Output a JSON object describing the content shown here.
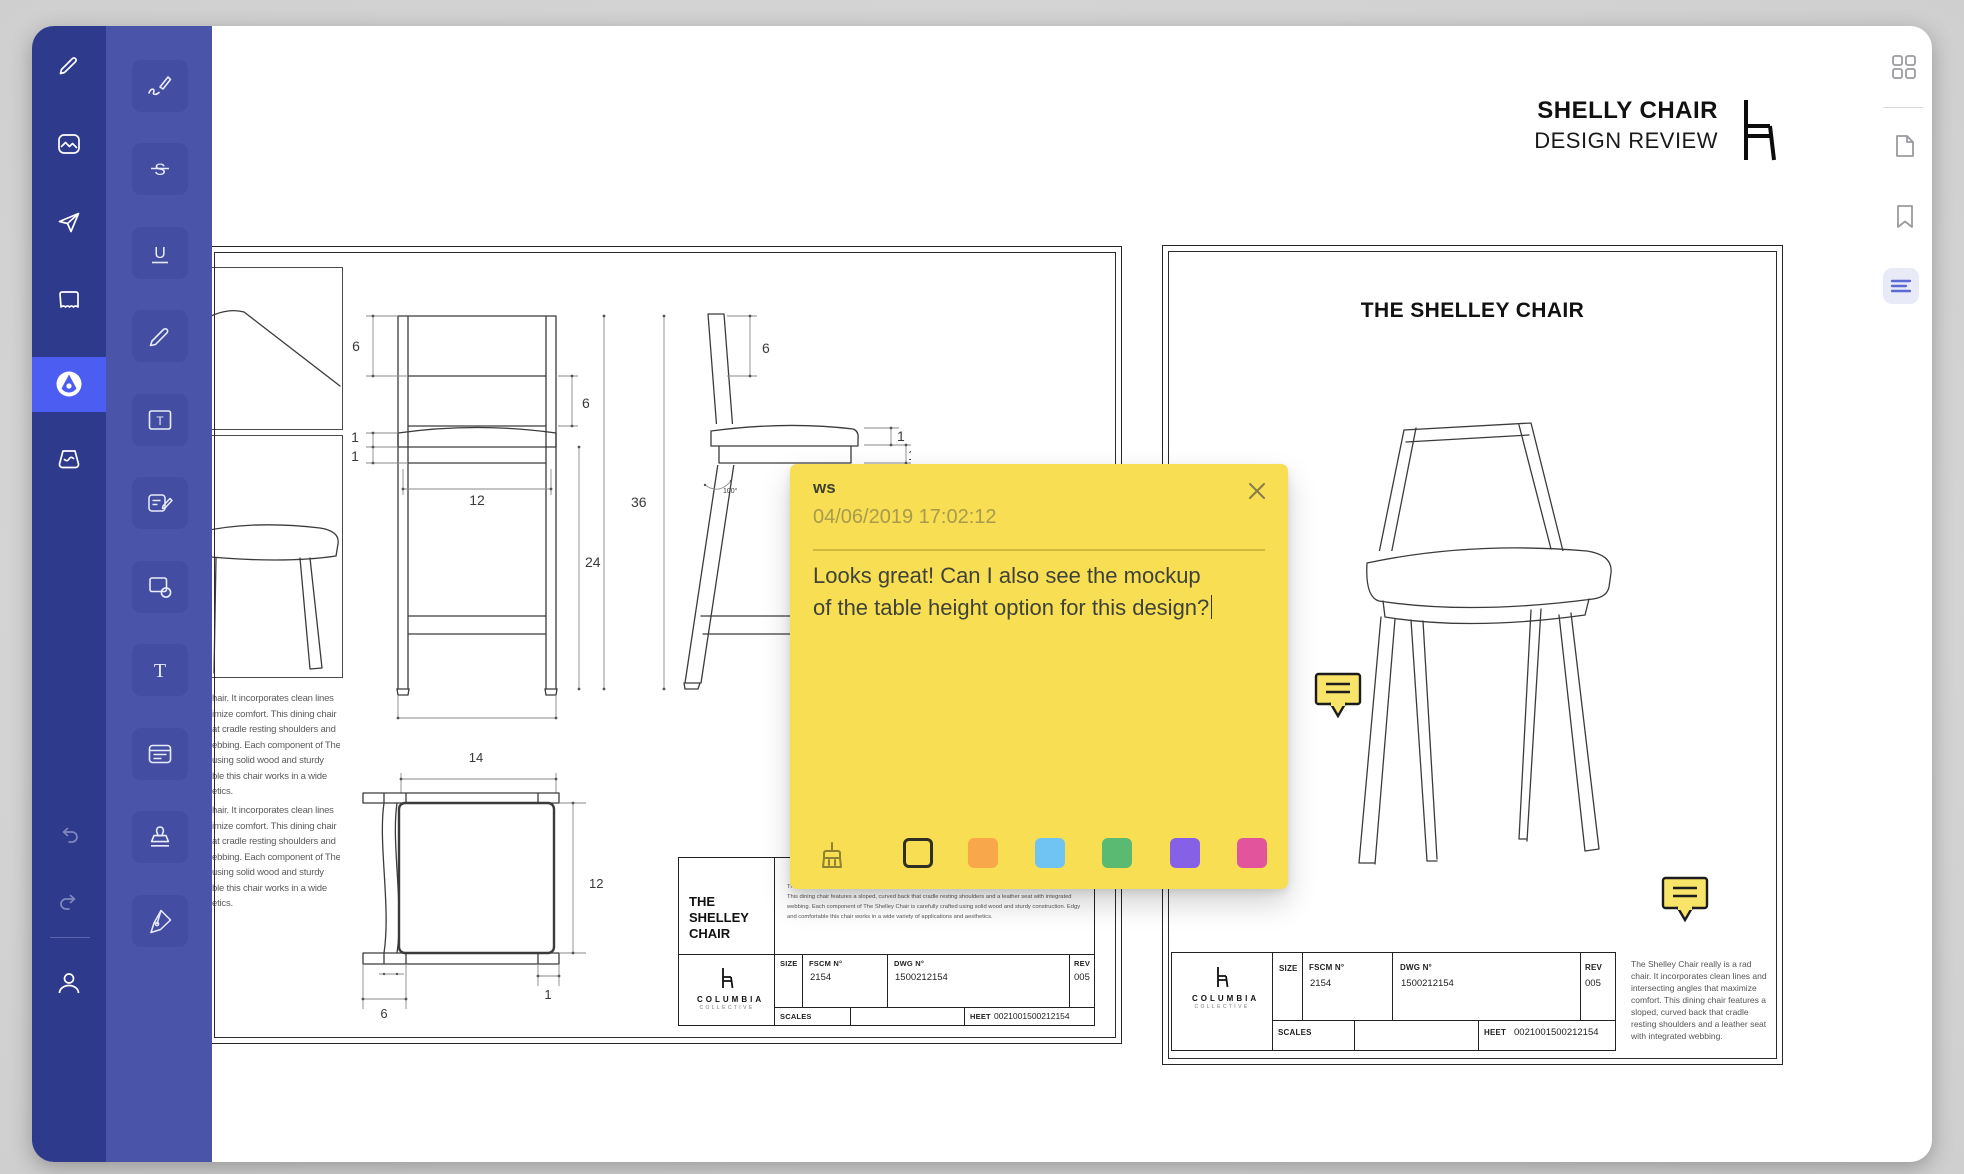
{
  "header": {
    "title": "SHELLY CHAIR",
    "subtitle": "DESIGN REVIEW"
  },
  "colors": {
    "note_bg": "#F8DE52",
    "marker_bg": "#F8E468",
    "sidebar_primary_bg": "#2E3A8C",
    "sidebar_tools_bg": "#4A55A9",
    "tool_button_bg": "#434EA3",
    "active_item_bg": "#4C5EF1",
    "rail_active_bg": "#E8EBF7",
    "rail_active_icon": "#5B6BD5",
    "swatches": [
      "#F9A74B",
      "#70C4F4",
      "#5BBA72",
      "#8661E8",
      "#E2549B"
    ]
  },
  "glyphs": {
    "strikethrough": "S",
    "underline": "U",
    "text_box": "T",
    "text": "T"
  },
  "note": {
    "author": "ws",
    "timestamp": "04/06/2019 17:02:12",
    "body_line1": "Looks great! Can I also see the mockup",
    "body_line2": "of the table height option for this design?"
  },
  "sheets": {
    "left": {
      "clipped_paragraph": [
        "hair. It incorporates clean lines",
        "imize comfort. This dining chair",
        "at cradle resting shoulders and",
        "ebbing. Each component of The",
        "using solid wood and sturdy",
        "ble this chair works in a wide",
        "etics."
      ],
      "front_dims": {
        "top": "6",
        "back": "6",
        "seat": "1",
        "apron": "1",
        "width": "12",
        "legs": "24",
        "height": "36"
      },
      "side_dims": {
        "back": "6",
        "seat": "1",
        "apron": "1",
        "angle": "100°"
      },
      "top_dims": {
        "width": "14",
        "depth": "12",
        "leg": "1",
        "side": "6"
      },
      "title_block": {
        "product": "THE SHELLEY CHAIR",
        "description": "The Shelley Chair really is a rad chair. It incorporates clean lines and intersecting angles that maximize comfort. This dining chair features a sloped, curved back that cradle resting shoulders and a leather seat with integrated webbing. Each component of The Shelley Chair is carefully crafted using solid wood and sturdy construction. Edgy and comfortable this chair works in a wide variety of applications and aesthetics.",
        "brand_top": "COLUMBIA",
        "brand_bottom": "COLLECTIVE",
        "size_label": "SIZE",
        "fscm_label": "FSCM N°",
        "fscm_value": "2154",
        "dwg_label": "DWG N°",
        "dwg_value": "1500212154",
        "rev_label": "REV",
        "rev_value": "005",
        "scales_label": "SCALES",
        "sheet_label": "HEET",
        "sheet_value": "0021001500212154"
      }
    },
    "right": {
      "title": "THE SHELLEY CHAIR",
      "description": "The Shelley Chair really is a rad chair. It incorporates clean lines and intersecting angles that maximize comfort. This dining chair features a sloped, curved back that cradle resting shoulders and a leather seat with integrated webbing.",
      "title_block": {
        "brand_top": "COLUMBIA",
        "brand_bottom": "COLLECTIVE",
        "size_label": "SIZE",
        "fscm_label": "FSCM N°",
        "fscm_value": "2154",
        "dwg_label": "DWG N°",
        "dwg_value": "1500212154",
        "rev_label": "REV",
        "rev_value": "005",
        "scales_label": "SCALES",
        "sheet_label": "HEET",
        "sheet_value": "0021001500212154"
      }
    }
  }
}
